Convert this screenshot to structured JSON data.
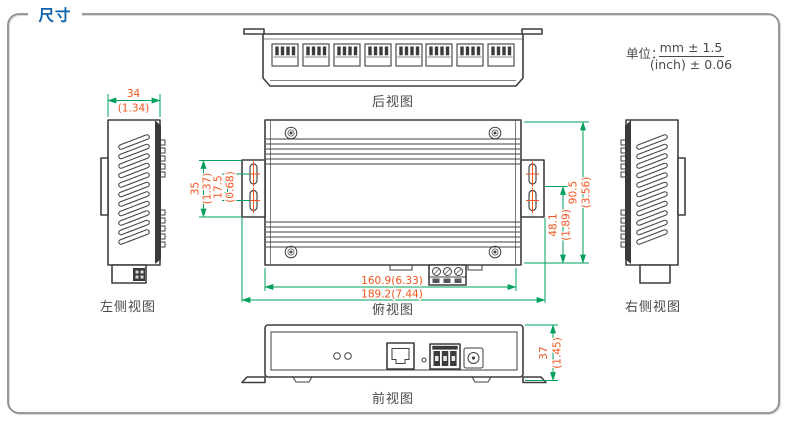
{
  "header": {
    "title": "尺寸"
  },
  "units": {
    "label": "单位：",
    "metric": "mm ± 1.5",
    "imperial": "(inch) ± 0.06"
  },
  "views": {
    "rear": {
      "label": "后视图"
    },
    "left": {
      "label": "左侧视图",
      "width_mm": "34",
      "width_in": "(1.34)"
    },
    "top": {
      "label": "俯视图",
      "bracket_mm": "35",
      "bracket_in": "(1.37)",
      "holes_mm": "17.5",
      "holes_in": "(0.68)",
      "body_width": "160.9(6.33)",
      "overall_width": "189.2(7.44)",
      "rail_mm": "48.1",
      "rail_in": "(1.89)",
      "depth_mm": "90.5",
      "depth_in": "(3.56)"
    },
    "right": {
      "label": "右侧视图"
    },
    "front": {
      "label": "前视图",
      "height_mm": "37",
      "height_in": "(1.45)"
    }
  },
  "colors": {
    "title": "#0a62ab",
    "frame": "#8f8f8f",
    "label": "#4a4a4a",
    "outline": "#3f3f3f",
    "dim_line": "#00a05c",
    "dim_text": "#f2541d"
  }
}
